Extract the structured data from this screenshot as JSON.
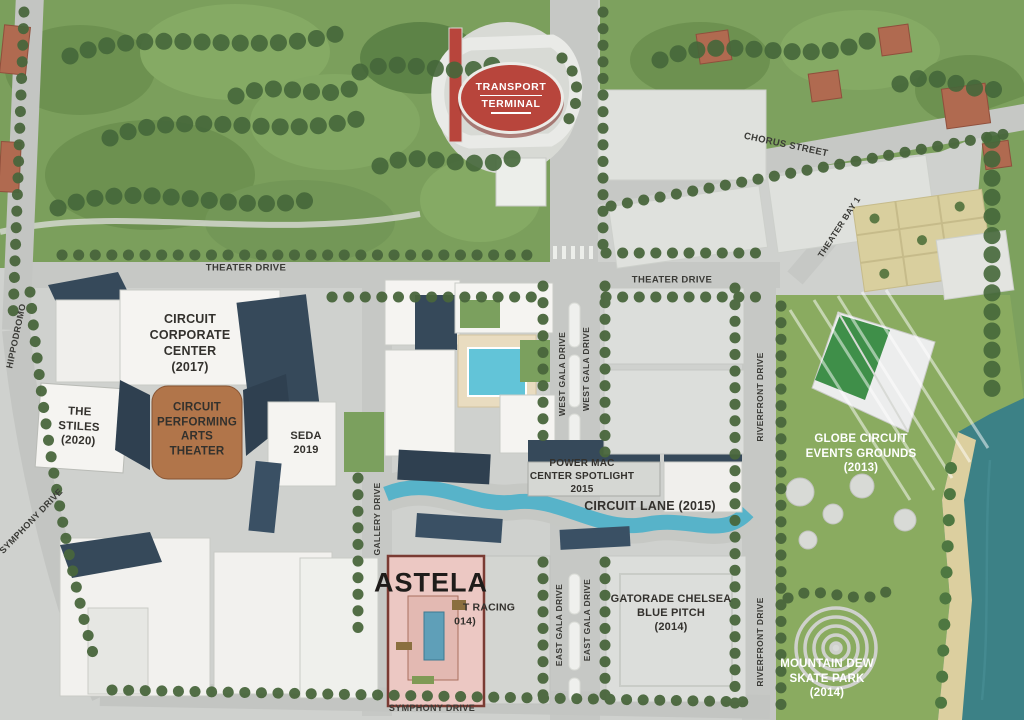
{
  "places": {
    "transport_terminal_line1": "TRANSPORT",
    "transport_terminal_line2": "TERMINAL",
    "circuit_corporate_center": "CIRCUIT\nCORPORATE\nCENTER\n(2017)",
    "the_stiles": "THE\nSTILES\n(2020)",
    "circuit_performing_arts_theater": "CIRCUIT\nPERFORMING\nARTS\nTHEATER",
    "seda_hotel": "SEDA\n2019",
    "power_mac_center_spotlight": "POWER MAC\nCENTER SPOTLIGHT\n2015",
    "circuit_lane": "CIRCUIT LANE (2015)",
    "globe_circuit_events_grounds": "GLOBE CIRCUIT\nEVENTS GROUNDS\n(2013)",
    "astela": "ASTELA",
    "kart_racing_fragment_line1": "T RACING",
    "kart_racing_fragment_line2": "014)",
    "gatorade_chelsea_blue_pitch": "GATORADE CHELSEA\nBLUE PITCH\n(2014)",
    "mountain_dew_skate_park": "MOUNTAIN DEW\nSKATE PARK\n(2014)"
  },
  "streets": {
    "chorus_street": "CHORUS STREET",
    "theater_bay_1": "THEATER BAY 1",
    "theater_drive": "THEATER DRIVE",
    "west_gala_drive": "WEST GALA DRIVE",
    "east_gala_drive": "EAST GALA DRIVE",
    "gallery_drive": "GALLERY DRIVE",
    "riverfront_drive": "RIVERFRONT DRIVE",
    "hippodromo": "HIPPODROMO",
    "symphony_drive": "SYMPHONY DRIVE"
  },
  "colors": {
    "terminal_red": "#b8453c",
    "theater_brown": "#b1754a",
    "astela_pink": "#ecc8c3",
    "pool_blue": "#62c4d8",
    "canal_blue": "#57b3c9",
    "water_teal": "#3c8186",
    "park_green": "#7b9f5c",
    "events_green": "#8aab60",
    "roof_slate": "#36495a",
    "road_gray": "#c6c8c5",
    "building_white": "#f5f4f1",
    "label_dark": "#33312d",
    "label_white": "#ffffff"
  }
}
